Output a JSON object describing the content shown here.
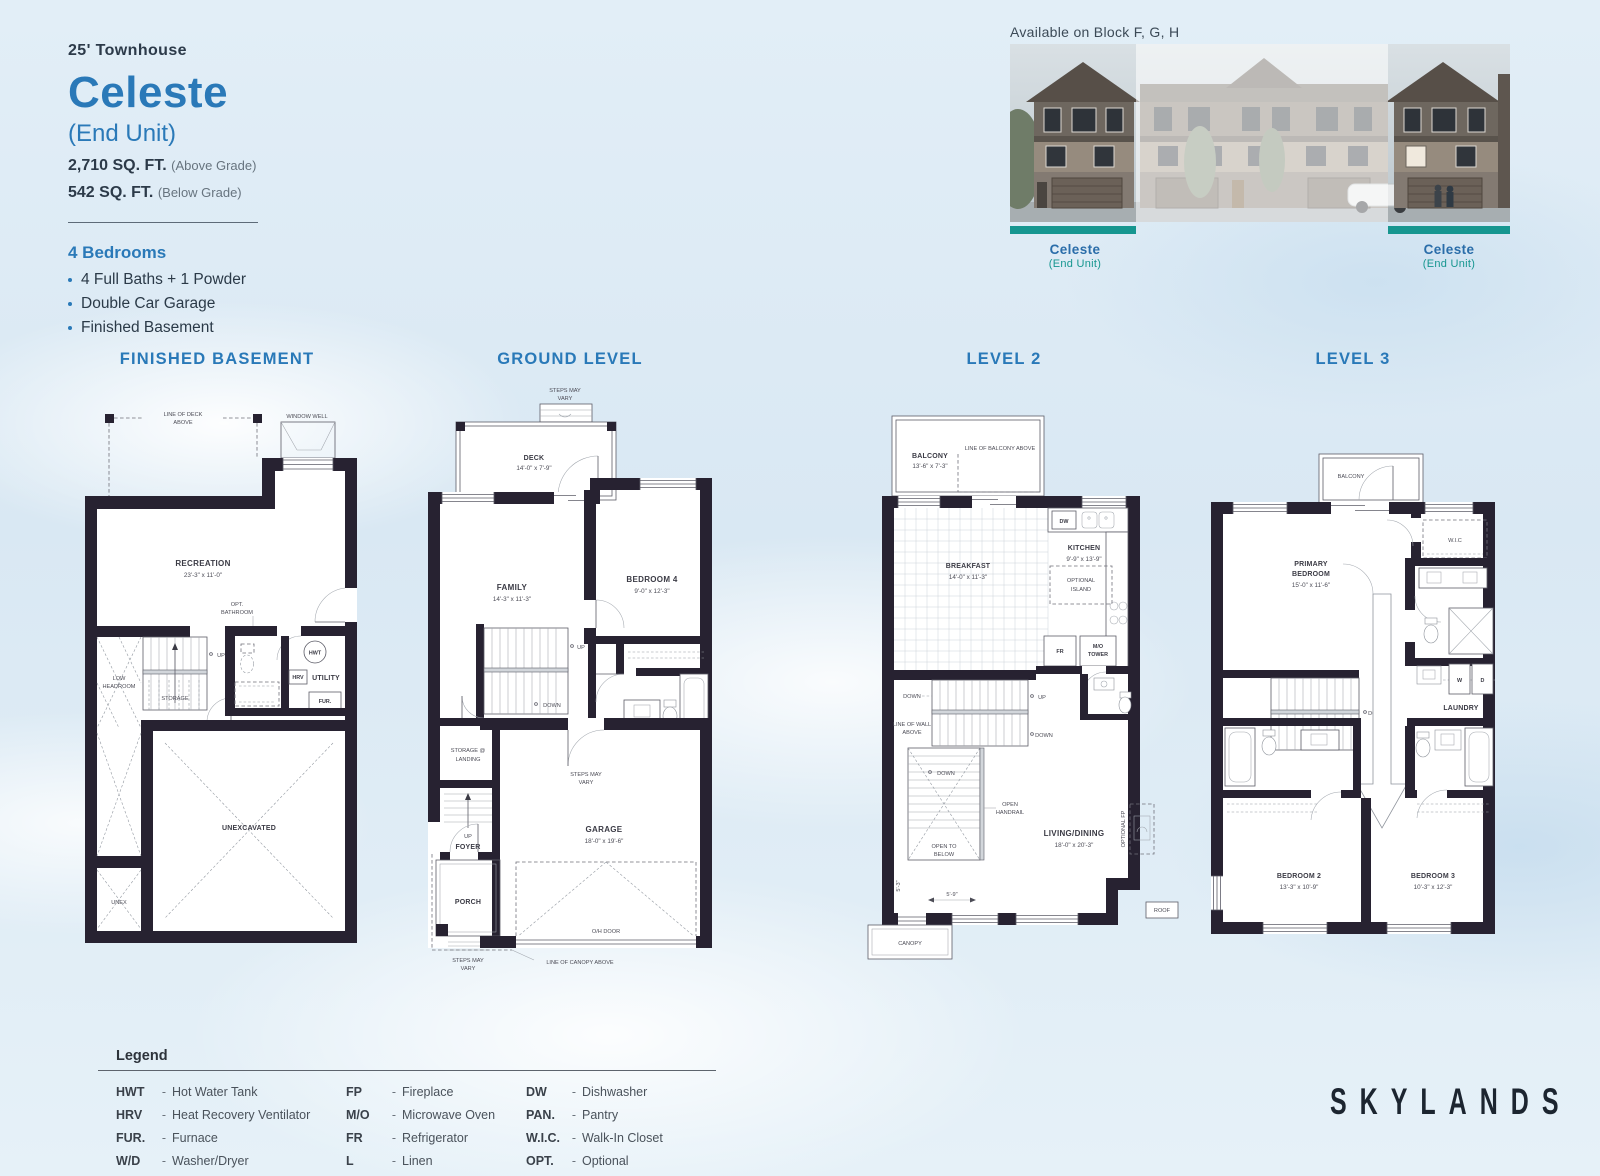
{
  "page": {
    "type_label": "25' Townhouse",
    "title": "Celeste",
    "subtitle": "(End Unit)",
    "area_above": "2,710 SQ. FT.",
    "area_above_note": "(Above Grade)",
    "area_below": "542 SQ. FT.",
    "area_below_note": "(Below Grade)",
    "bedrooms_heading": "4 Bedrooms",
    "features": [
      "4 Full Baths + 1 Powder",
      "Double Car Garage",
      "Finished Basement"
    ],
    "brand": "SKYLANDS"
  },
  "elevation": {
    "availability": "Available on Block F, G, H",
    "left_label": "Celeste",
    "left_sublabel": "(End Unit)",
    "right_label": "Celeste",
    "right_sublabel": "(End Unit)"
  },
  "plans": {
    "basement": {
      "title": "FINISHED BASEMENT",
      "labels": {
        "line_of_deck_1": "LINE OF DECK",
        "line_of_deck_2": "ABOVE",
        "window_well": "WINDOW WELL",
        "recreation": "RECREATION",
        "recreation_dims": "23'-3\" x 11'-0\"",
        "opt_bath_1": "OPT.",
        "opt_bath_2": "BATHROOM",
        "up": "UP",
        "low_headroom_1": "LOW",
        "low_headroom_2": "HEADROOM",
        "storage": "STORAGE",
        "hwt": "HWT",
        "hrv": "HRV",
        "utility": "UTILITY",
        "fur": "FUR.",
        "unexcavated": "UNEXCAVATED",
        "unex": "UNEX"
      }
    },
    "ground": {
      "title": "GROUND LEVEL",
      "labels": {
        "steps_1": "STEPS MAY",
        "steps_2": "VARY",
        "deck": "DECK",
        "deck_dims": "14'-0\" x 7'-9\"",
        "family": "FAMILY",
        "family_dims": "14'-3\" x 11'-3\"",
        "bedroom4": "BEDROOM 4",
        "bedroom4_dims": "9'-0\" x 12'-3\"",
        "up": "UP",
        "down": "DOWN",
        "storage_1": "STORAGE @",
        "storage_2": "LANDING",
        "garage": "GARAGE",
        "garage_dims": "18'-0\" x 19'-6\"",
        "foyer": "FOYER",
        "porch": "PORCH",
        "oh_door": "O/H DOOR",
        "canopy_line": "LINE OF CANOPY ABOVE"
      }
    },
    "level2": {
      "title": "LEVEL 2",
      "labels": {
        "balcony": "BALCONY",
        "balcony_dims": "13'-6\" x 7'-3\"",
        "balcony_line": "LINE OF BALCONY ABOVE",
        "breakfast": "BREAKFAST",
        "breakfast_dims": "14'-0\" x 11'-3\"",
        "kitchen": "KITCHEN",
        "kitchen_dims": "9'-9\" x 13'-9\"",
        "dw": "DW",
        "island_1": "OPTIONAL",
        "island_2": "ISLAND",
        "fr": "FR",
        "mo_1": "M/O",
        "mo_2": "TOWER",
        "down": "DOWN",
        "up": "UP",
        "wall_line_1": "LINE OF WALL",
        "wall_line_2": "ABOVE",
        "handrail_1": "OPEN",
        "handrail_2": "HANDRAIL",
        "open_below_1": "OPEN TO",
        "open_below_2": "BELOW",
        "living": "LIVING/DINING",
        "living_dims": "18'-0\" x 20'-3\"",
        "optional_fp": "OPTIONAL FP",
        "dim_5_3": "5'-3\"",
        "dim_5_9": "5'-9\"",
        "canopy": "CANOPY",
        "roof": "ROOF"
      }
    },
    "level3": {
      "title": "LEVEL 3",
      "labels": {
        "balcony": "BALCONY",
        "wic": "W.I.C",
        "primary_1": "PRIMARY",
        "primary_2": "BEDROOM",
        "primary_dims": "15'-0\" x 11'-6\"",
        "down": "DOWN",
        "w": "W",
        "d": "D",
        "laundry": "LAUNDRY",
        "bedroom2": "BEDROOM 2",
        "bedroom2_dims": "13'-3\" x 10'-9\"",
        "bedroom3": "BEDROOM 3",
        "bedroom3_dims": "10'-3\" x 12'-3\""
      }
    }
  },
  "legend": {
    "heading": "Legend",
    "sep": "-",
    "columns": [
      [
        {
          "abbr": "HWT",
          "desc": "Hot Water Tank"
        },
        {
          "abbr": "HRV",
          "desc": "Heat Recovery Ventilator"
        },
        {
          "abbr": "FUR.",
          "desc": "Furnace"
        },
        {
          "abbr": "W/D",
          "desc": "Washer/Dryer"
        }
      ],
      [
        {
          "abbr": "FP",
          "desc": "Fireplace"
        },
        {
          "abbr": "M/O",
          "desc": "Microwave Oven"
        },
        {
          "abbr": "FR",
          "desc": "Refrigerator"
        },
        {
          "abbr": "L",
          "desc": "Linen"
        }
      ],
      [
        {
          "abbr": "DW",
          "desc": "Dishwasher"
        },
        {
          "abbr": "PAN.",
          "desc": "Pantry"
        },
        {
          "abbr": "W.I.C.",
          "desc": "Walk-In Closet"
        },
        {
          "abbr": "OPT.",
          "desc": "Optional"
        }
      ]
    ]
  },
  "colors": {
    "accent_blue": "#2a79b8",
    "teal": "#169690",
    "wall": "#272231"
  }
}
